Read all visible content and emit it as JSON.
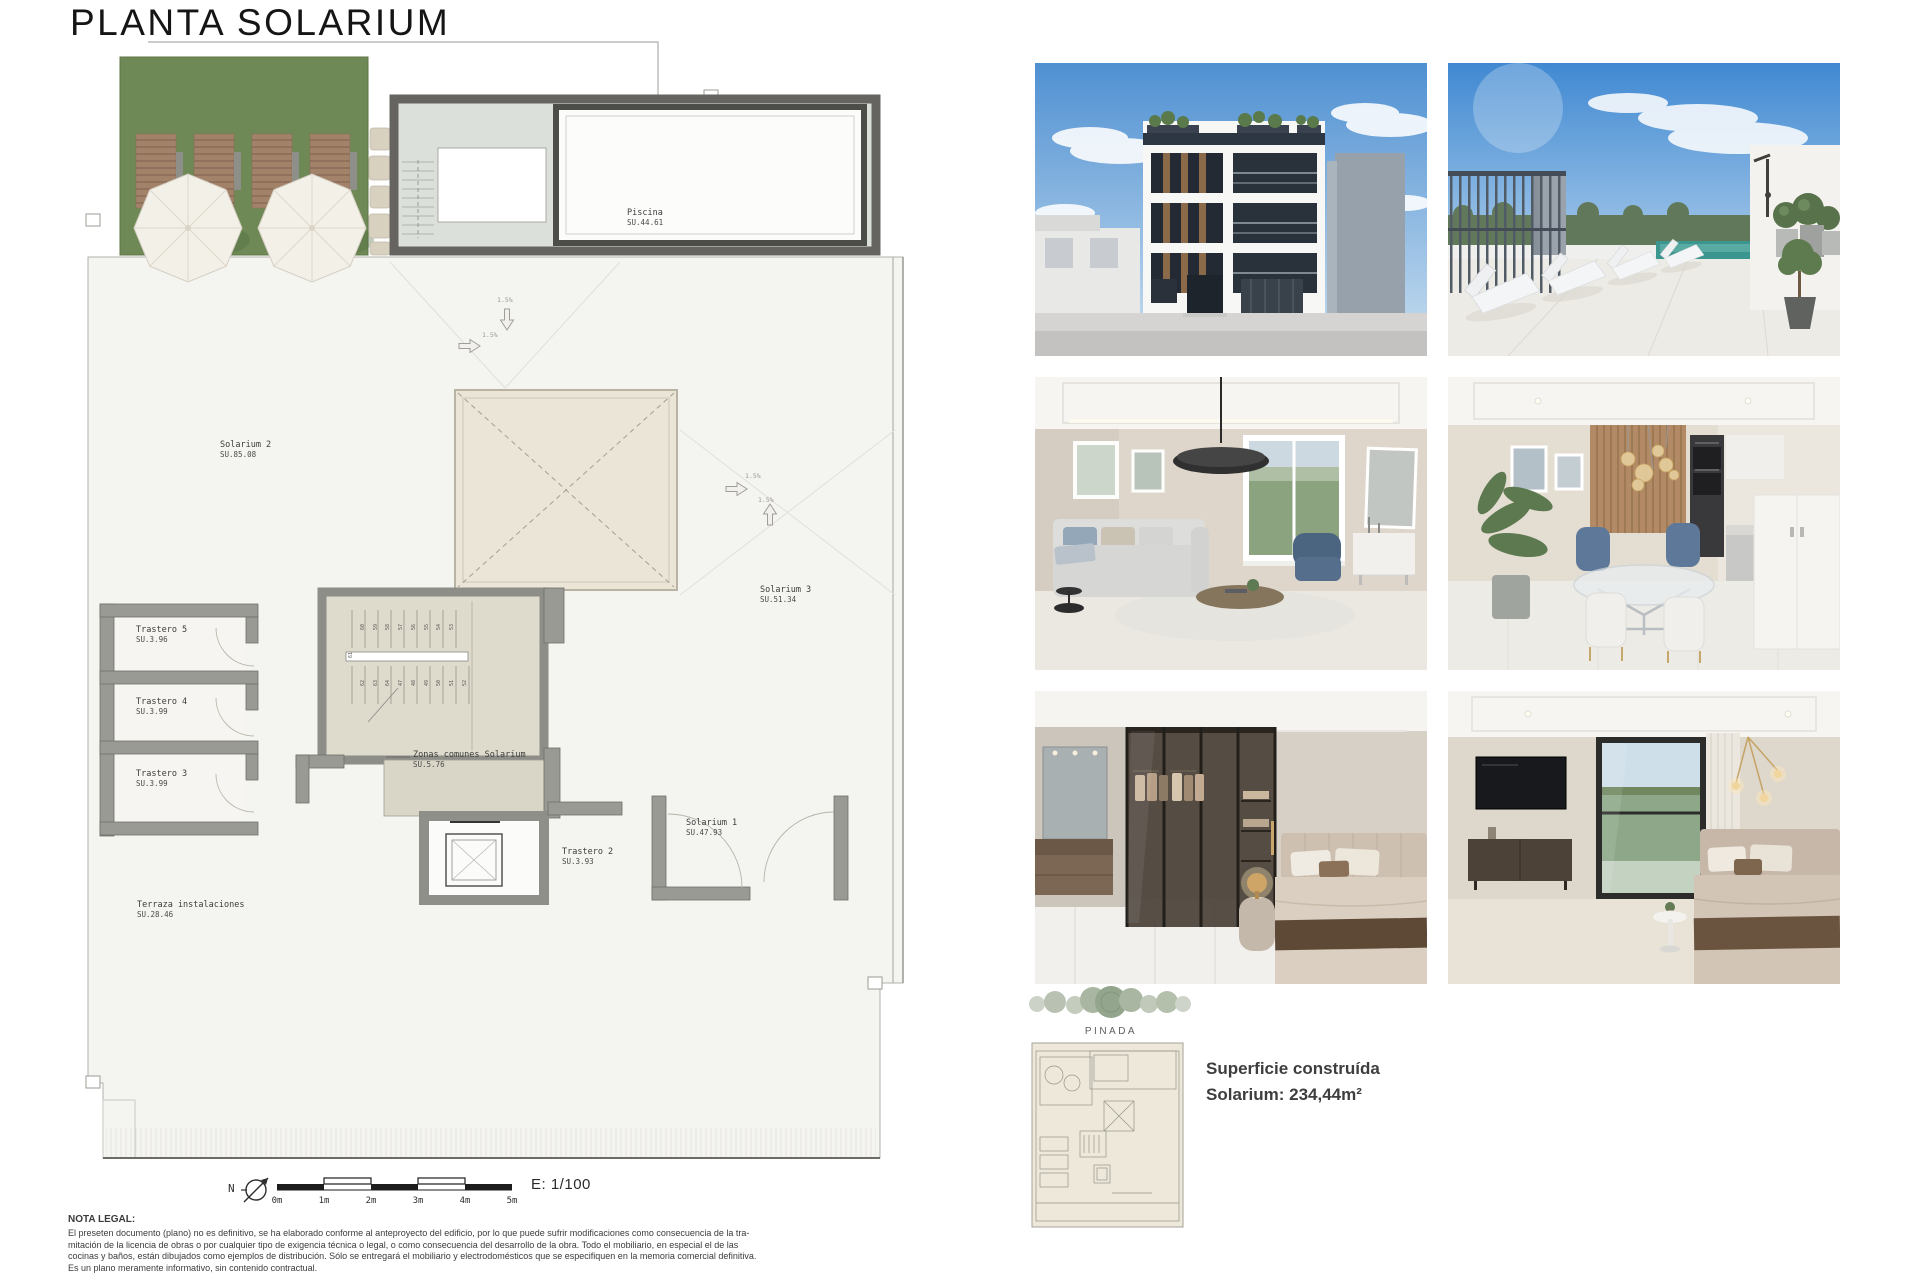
{
  "title": "PLANTA SOLARIUM",
  "plan": {
    "labels": {
      "piscina": {
        "name": "Piscina",
        "area": "SU.44.61"
      },
      "solarium2": {
        "name": "Solarium 2",
        "area": "SU.85.08"
      },
      "solarium3": {
        "name": "Solarium 3",
        "area": "SU.51.34"
      },
      "solarium1": {
        "name": "Solarium 1",
        "area": "SU.47.93"
      },
      "trastero5": {
        "name": "Trastero 5",
        "area": "SU.3.96"
      },
      "trastero4": {
        "name": "Trastero 4",
        "area": "SU.3.99"
      },
      "trastero3": {
        "name": "Trastero 3",
        "area": "SU.3.99"
      },
      "trastero2": {
        "name": "Trastero 2",
        "area": "SU.3.93"
      },
      "zonas": {
        "name": "Zonas comunes Solarium",
        "area": "SU.5.76"
      },
      "terraza": {
        "name": "Terraza instalaciones",
        "area": "SU.28.46"
      }
    },
    "slope": "1.5%",
    "north": "N",
    "scale_ticks": [
      "0m",
      "1m",
      "2m",
      "3m",
      "4m",
      "5m"
    ],
    "scale_ratio": "E: 1/100",
    "stair_numbers_upper": [
      "60",
      "59",
      "58",
      "57",
      "56",
      "55",
      "54",
      "53"
    ],
    "stair_numbers_mid": "61",
    "stair_numbers_lower": [
      "62",
      "63",
      "64",
      "47",
      "48",
      "49",
      "50",
      "51",
      "52"
    ]
  },
  "legal": {
    "heading": "NOTA LEGAL:",
    "line1": "El preseten documento (plano) no es definitivo, se ha elaborado conforme al anteproyecto del edificio, por lo que puede sufrir modificaciones como consecuencia de la tra-",
    "line2": "mitación de la licencia de obras o por cualquier tipo de exigencia técnica o legal, o como consecuencia del desarrollo de la obra. Todo el mobiliario, en especial el de las",
    "line3": "cocinas y baños, están dibujados como ejemplos de distribución. Sólo se entregará el mobiliario y electrodomésticos que se especifiquen en la memoria comercial definitiva.",
    "line4": "Es un plano meramente informativo, sin contenido contractual."
  },
  "brand": "PINADA",
  "summary": {
    "line1": "Superficie construída",
    "line2": "Solarium: 234,44m²"
  },
  "colors": {
    "grass": "#6e8955",
    "wall_gray": "#8f8f89",
    "terrace": "#f4f4f1",
    "pool_teal": "#3a968f",
    "sky_blue": "#4f90d2"
  },
  "photos": [
    {
      "name": "building-facade-render"
    },
    {
      "name": "rooftop-pool-terrace-render"
    },
    {
      "name": "living-room-render"
    },
    {
      "name": "dining-kitchen-render"
    },
    {
      "name": "bedroom-wardrobe-render"
    },
    {
      "name": "bedroom-window-render"
    }
  ]
}
